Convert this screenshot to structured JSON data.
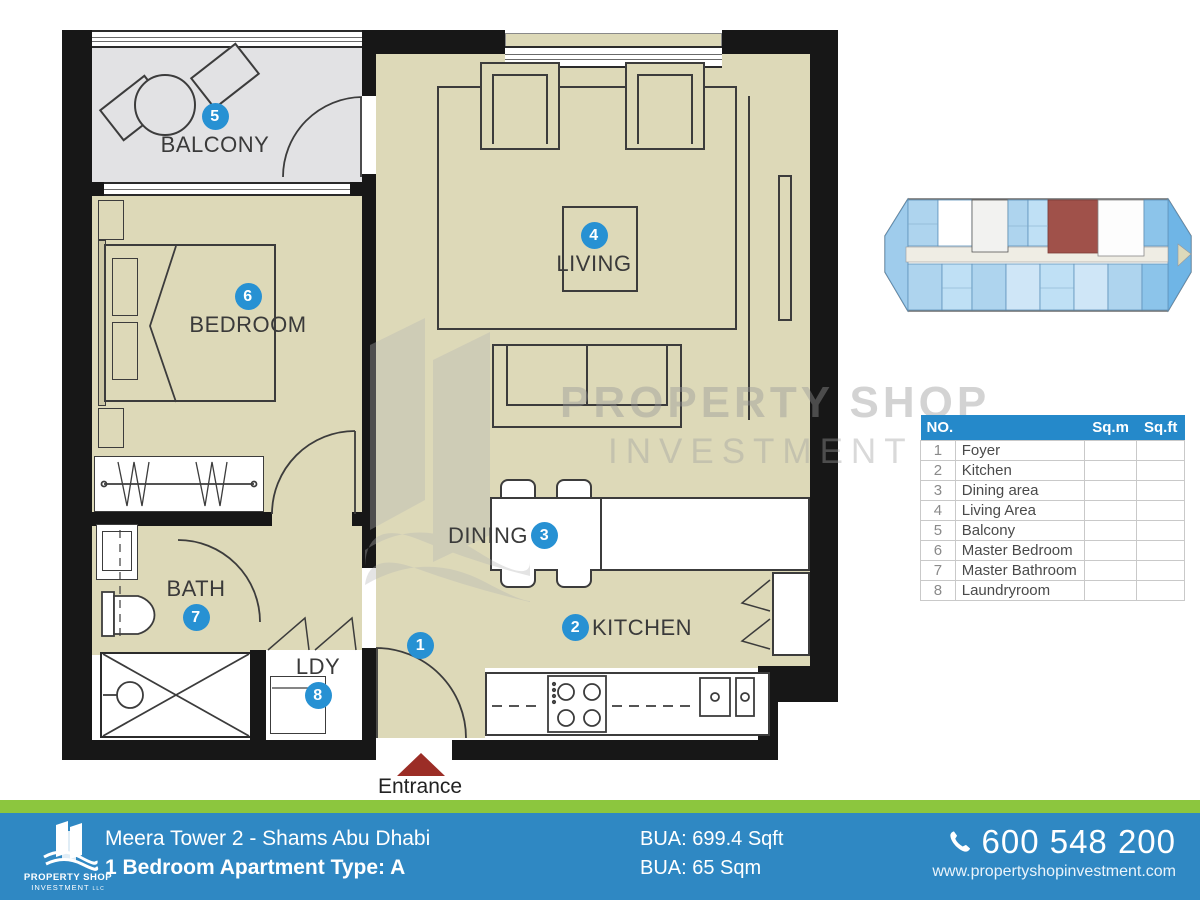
{
  "colors": {
    "badge_blue": "#2791d3",
    "table_header_blue": "#2589ca",
    "footer_blue": "#2f88c3",
    "footer_green": "#8cc63e",
    "floor_beige": "#ddd9b8",
    "balcony_gray": "#e2e2e4",
    "wall_black": "#171717",
    "entrance_red": "#9b2d26",
    "keyplan_unit_blue": "#aed4ee",
    "keyplan_highlight_red": "#a0514a"
  },
  "plan": {
    "labels": {
      "balcony": "BALCONY",
      "bedroom": "BEDROOM",
      "living": "LIVING",
      "dining": "DINING",
      "kitchen": "KITCHEN",
      "bath": "BATH",
      "ldy": "LDY"
    },
    "badges": {
      "foyer": "1",
      "kitchen": "2",
      "dining": "3",
      "living": "4",
      "balcony": "5",
      "bedroom": "6",
      "bath": "7",
      "ldy": "8"
    },
    "entrance_label": "Entrance"
  },
  "watermark": {
    "line1": "PROPERTY SHOP",
    "line2": "INVESTMENT",
    "suffix": "LLC"
  },
  "table": {
    "col_no": "NO.",
    "col_sqm": "Sq.m",
    "col_sqft": "Sq.ft",
    "rows": [
      {
        "no": "1",
        "name": "Foyer",
        "sqm": "",
        "sqft": ""
      },
      {
        "no": "2",
        "name": "Kitchen",
        "sqm": "",
        "sqft": ""
      },
      {
        "no": "3",
        "name": "Dining area",
        "sqm": "",
        "sqft": ""
      },
      {
        "no": "4",
        "name": "Living Area",
        "sqm": "",
        "sqft": ""
      },
      {
        "no": "5",
        "name": "Balcony",
        "sqm": "",
        "sqft": ""
      },
      {
        "no": "6",
        "name": "Master Bedroom",
        "sqm": "",
        "sqft": ""
      },
      {
        "no": "7",
        "name": "Master Bathroom",
        "sqm": "",
        "sqft": ""
      },
      {
        "no": "8",
        "name": "Laundryroom",
        "sqm": "",
        "sqft": ""
      }
    ]
  },
  "footer": {
    "logo_name": "PROPERTY SHOP",
    "logo_sub": "INVESTMENT",
    "logo_suffix": "LLC",
    "title_line1": "Meera Tower 2 - Shams Abu Dhabi",
    "title_line2": "1 Bedroom Apartment Type: A",
    "bua_line1": "BUA: 699.4 Sqft",
    "bua_line2": "BUA: 65 Sqm",
    "phone": "600 548 200",
    "website": "www.propertyshopinvestment.com"
  }
}
